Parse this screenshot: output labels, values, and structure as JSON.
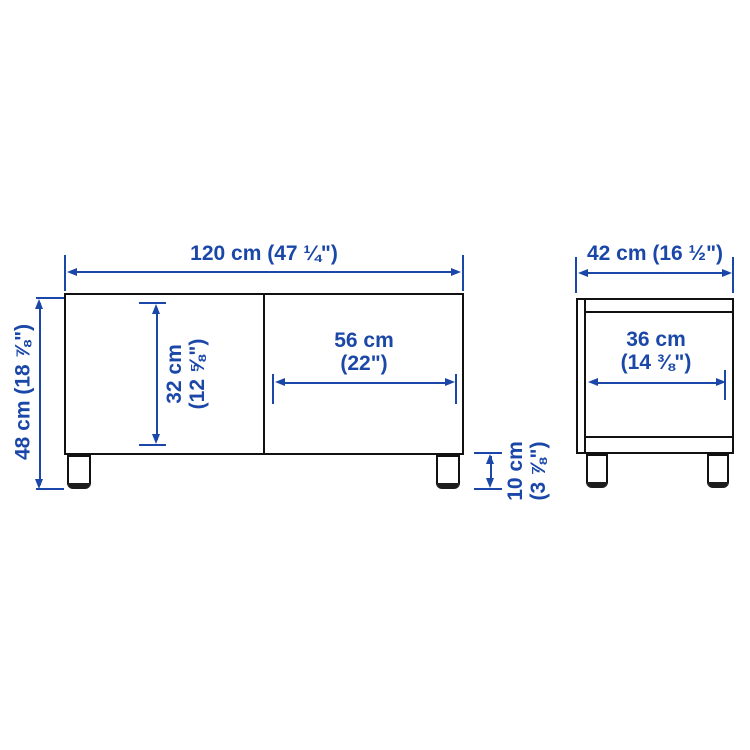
{
  "diagram_type": "furniture-dimension-diagram",
  "colors": {
    "dimension_blue": "#1a47a8",
    "outline_black": "#111111",
    "background": "#ffffff"
  },
  "front_view": {
    "overall_width_label": "120 cm (47 ¼\")",
    "overall_height_label": "48 cm (18 ⅞\")",
    "interior_height_line1": "32 cm",
    "interior_height_line2": "(12 ⅝\")",
    "door_width_line1": "56 cm",
    "door_width_line2": "(22\")",
    "leg_height_line1": "10 cm",
    "leg_height_line2": "(3 ⅞\")"
  },
  "side_view": {
    "overall_depth_label": "42 cm (16 ½\")",
    "interior_depth_line1": "36 cm",
    "interior_depth_line2": "(14 ⅜\")"
  }
}
